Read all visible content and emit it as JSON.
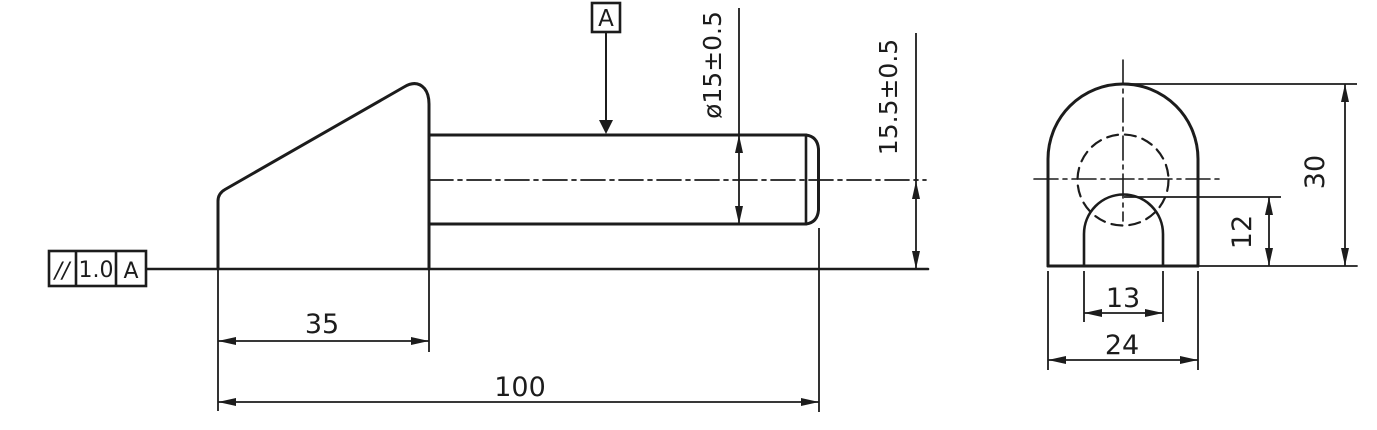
{
  "page": {
    "background": "#ffffff",
    "line_color": "#1c1c1c"
  },
  "views": {
    "side_view": {
      "datum_flag": "A",
      "feature_control_frame": {
        "symbol": "//",
        "tolerance": "1.0",
        "datum": "A"
      },
      "dimensions": {
        "shaft_diameter": "ø15±0.5",
        "axis_height": "15.5±0.5",
        "wedge_length": "35",
        "overall_length": "100"
      }
    },
    "end_view": {
      "dimensions": {
        "overall_height": "30",
        "slot_depth": "12",
        "slot_width": "13",
        "overall_width": "24"
      }
    }
  }
}
